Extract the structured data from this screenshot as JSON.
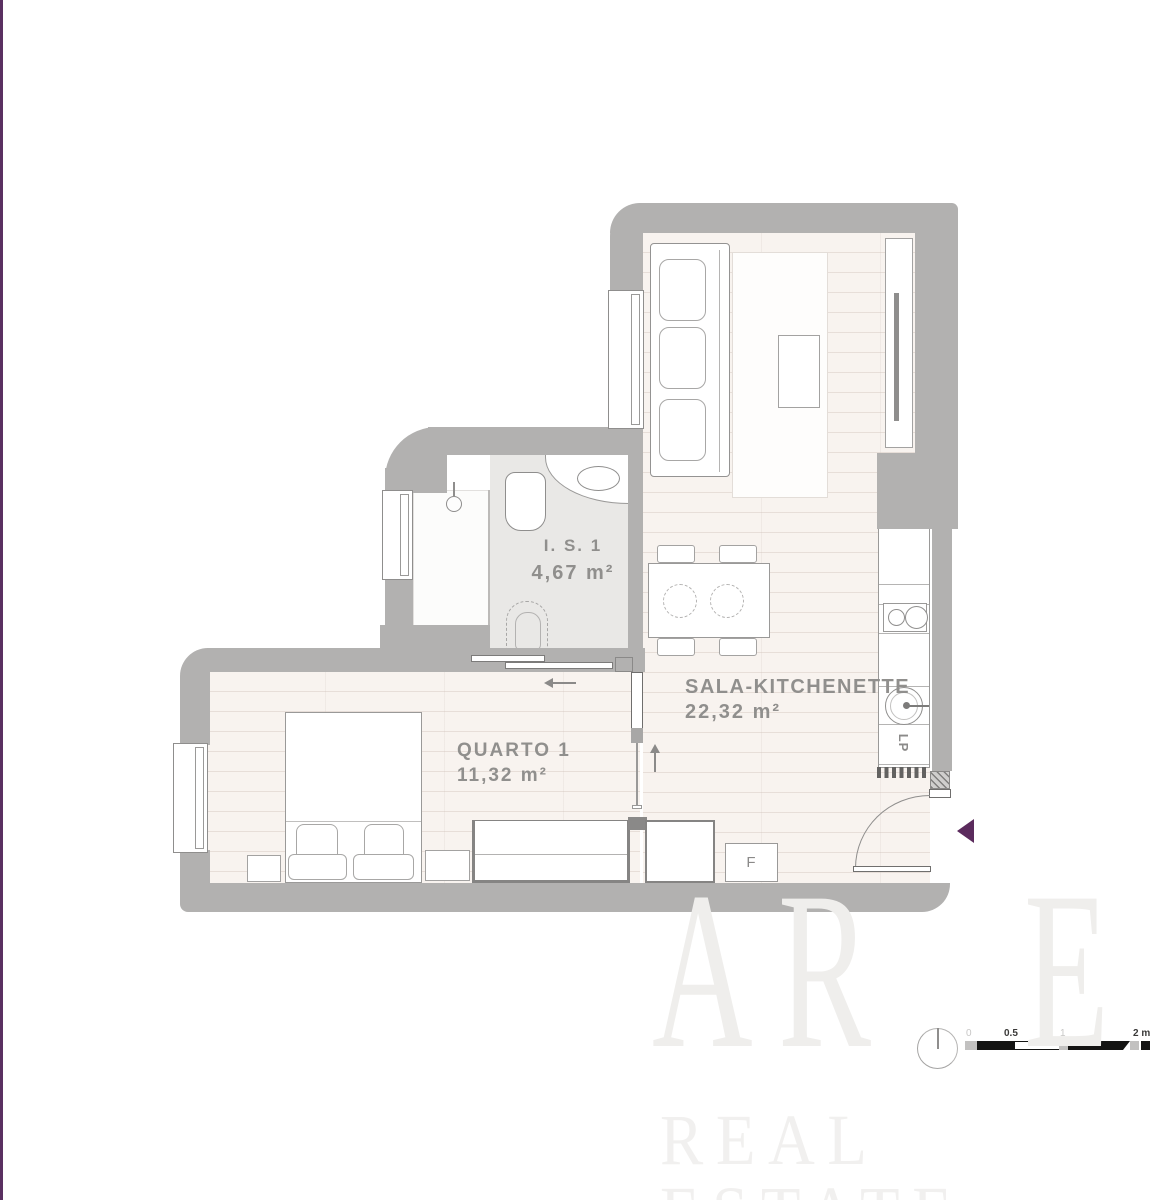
{
  "plan": {
    "rooms": [
      {
        "name": "I. S. 1",
        "area": "4,67 m²"
      },
      {
        "name": "QUARTO 1",
        "area": "11,32 m²"
      },
      {
        "name": "SALA-KITCHENETTE",
        "area": "22,32 m²"
      }
    ],
    "labels": {
      "fridge": "F",
      "kitchen_lp": "LP"
    }
  },
  "scale_bar": {
    "ticks": [
      "0",
      "0.5",
      "1",
      "2 m"
    ]
  },
  "watermark": {
    "word": "ARE",
    "letters": [
      "A",
      "R",
      "E"
    ],
    "line2": "REAL ESTATE"
  },
  "colors": {
    "wall": "#b2b1b0",
    "accent_edge": "#5a3061",
    "entry_marker": "#5b2b5d",
    "bathroom_floor": "#e9e8e6",
    "wood_floor": "#f8f3ef",
    "label_text": "#908f8d"
  }
}
